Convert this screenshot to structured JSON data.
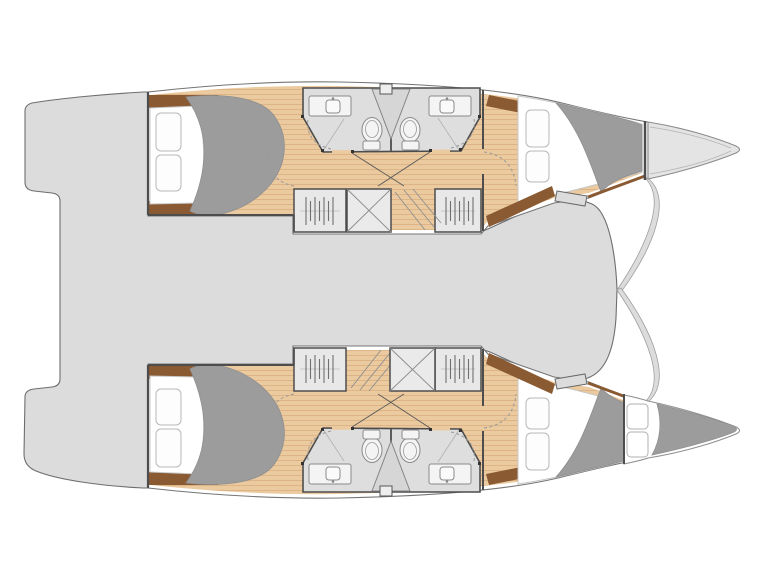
{
  "diagram": {
    "type": "boat-floor-plan",
    "subject": "catamaran interior deck plan, bow pointing right, two symmetric hulls",
    "orientation": "bow-right"
  },
  "colors": {
    "background": "#ffffff",
    "deck": "#dcdcdc",
    "deck_outline": "#6e6e6e",
    "hull_fill": "#ffffff",
    "hull_outline": "#757575",
    "wood_floor": "#ecca9f",
    "plank_line": "#d8ac7e",
    "trim_brown": "#8a5a32",
    "bedding_gray": "#9c9c9c",
    "mattress_white": "#ffffff",
    "bathroom_floor": "#dedede",
    "fixture_outline": "#8a8a8a",
    "locker_fill": "#e8e8e8",
    "wall_dark": "#4d4d4d",
    "forepeak_fill": "#e4e4e4"
  },
  "hulls": [
    {
      "id": "port-hull",
      "position": "top",
      "rooms": [
        "aft-double-cabin",
        "aft-bathroom",
        "forward-bathroom",
        "forward-double-cabin"
      ],
      "features": [
        "double-bed",
        "pillows",
        "wardrobe-locker",
        "storage-locker",
        "companionway-stairs",
        "entry-step"
      ],
      "bow": "storage-forepeak"
    },
    {
      "id": "starboard-hull",
      "position": "bottom",
      "rooms": [
        "aft-double-cabin",
        "aft-bathroom",
        "forward-bathroom",
        "forward-double-cabin"
      ],
      "features": [
        "double-bed",
        "pillows",
        "wardrobe-locker",
        "storage-locker",
        "companionway-stairs",
        "entry-step"
      ],
      "bow": "skipper-berth"
    }
  ],
  "center_sections": [
    "transom-platform-aft",
    "bridgedeck-footprint",
    "open-foredeck-area"
  ]
}
